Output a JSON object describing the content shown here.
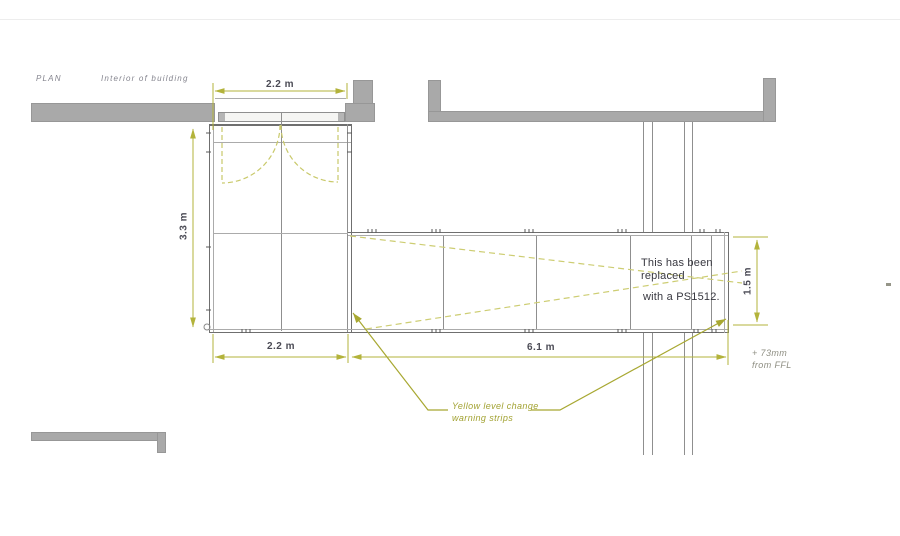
{
  "header": {
    "plan_label": "PLAN",
    "interior_label": "Interior of building"
  },
  "dimensions": {
    "door_width": "2.2 m",
    "vestibule_depth": "3.3 m",
    "vestibule_width": "2.2 m",
    "walkway_length": "6.1 m",
    "walkway_width": "1.5 m"
  },
  "annotations": {
    "replacement": {
      "line1": "This has been",
      "line2": "replaced",
      "line3": "with a PS1512."
    },
    "warning": {
      "line1": "Yellow level change",
      "line2": "warning strips"
    },
    "ffl": {
      "line1": "+ 73mm",
      "line2": "from FFL"
    }
  },
  "colors": {
    "wall_gray": "#a9a9a9",
    "dimension_olive": "#b3b33b",
    "dashed_olive": "#cdcd72",
    "leader_olive": "#a8a832",
    "line_gray": "#8f8f8f"
  }
}
